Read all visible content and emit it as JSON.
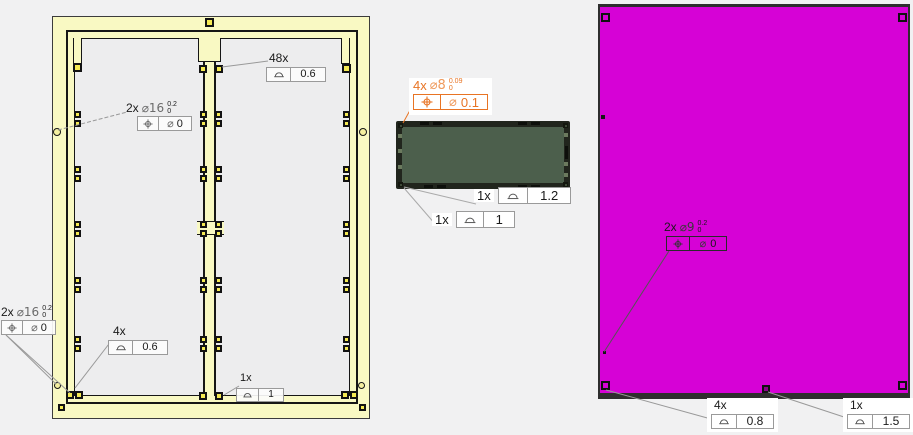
{
  "view": {
    "background": "#f1f1f2",
    "description": "GD&T tolerance annotation view with three parts"
  },
  "parts": {
    "frame": {
      "label": "yellow frame with center divider",
      "color": "#f9f9c3"
    },
    "panel": {
      "label": "green rectangular panel",
      "color": "#4c5f4c"
    },
    "plate": {
      "label": "magenta plate",
      "color": "#d602d6"
    }
  },
  "annotations": {
    "frame_48x": {
      "count": "48x",
      "fcf": {
        "symbol": "profile-of-surface",
        "value": "0.6"
      }
    },
    "frame_2x16_mid": {
      "count": "2x",
      "diameter": "⌀16",
      "tol_upper": "0.2",
      "tol_lower": "0",
      "fcf": {
        "symbol": "position",
        "diameter": "⌀",
        "value": "0"
      }
    },
    "frame_2x16_corner": {
      "count": "2x",
      "diameter": "⌀16",
      "tol_upper": "0.2",
      "tol_lower": "0",
      "fcf": {
        "symbol": "position",
        "diameter": "⌀",
        "value": "0"
      }
    },
    "frame_4x": {
      "count": "4x",
      "fcf": {
        "symbol": "profile-of-surface",
        "value": "0.6"
      }
    },
    "frame_1x": {
      "count": "1x",
      "fcf": {
        "symbol": "profile-of-surface",
        "value": "1"
      }
    },
    "panel_4x8": {
      "count": "4x",
      "diameter": "⌀8",
      "tol_upper": "0.09",
      "tol_lower": "0",
      "accent": "#e87424",
      "fcf": {
        "symbol": "position",
        "diameter": "⌀",
        "value": "0.1"
      }
    },
    "panel_1x_a": {
      "count": "1x",
      "fcf": {
        "symbol": "profile-of-surface",
        "value": "1.2"
      }
    },
    "panel_1x_b": {
      "count": "1x",
      "fcf": {
        "symbol": "profile-of-surface",
        "value": "1"
      }
    },
    "plate_2x9": {
      "count": "2x",
      "diameter": "⌀9",
      "tol_upper": "0.2",
      "tol_lower": "0",
      "fcf": {
        "symbol": "position",
        "diameter": "⌀",
        "value": "0"
      }
    },
    "plate_4x": {
      "count": "4x",
      "fcf": {
        "symbol": "profile-of-surface",
        "value": "0.8"
      }
    },
    "plate_1x": {
      "count": "1x",
      "fcf": {
        "symbol": "profile-of-surface",
        "value": "1.5"
      }
    }
  }
}
